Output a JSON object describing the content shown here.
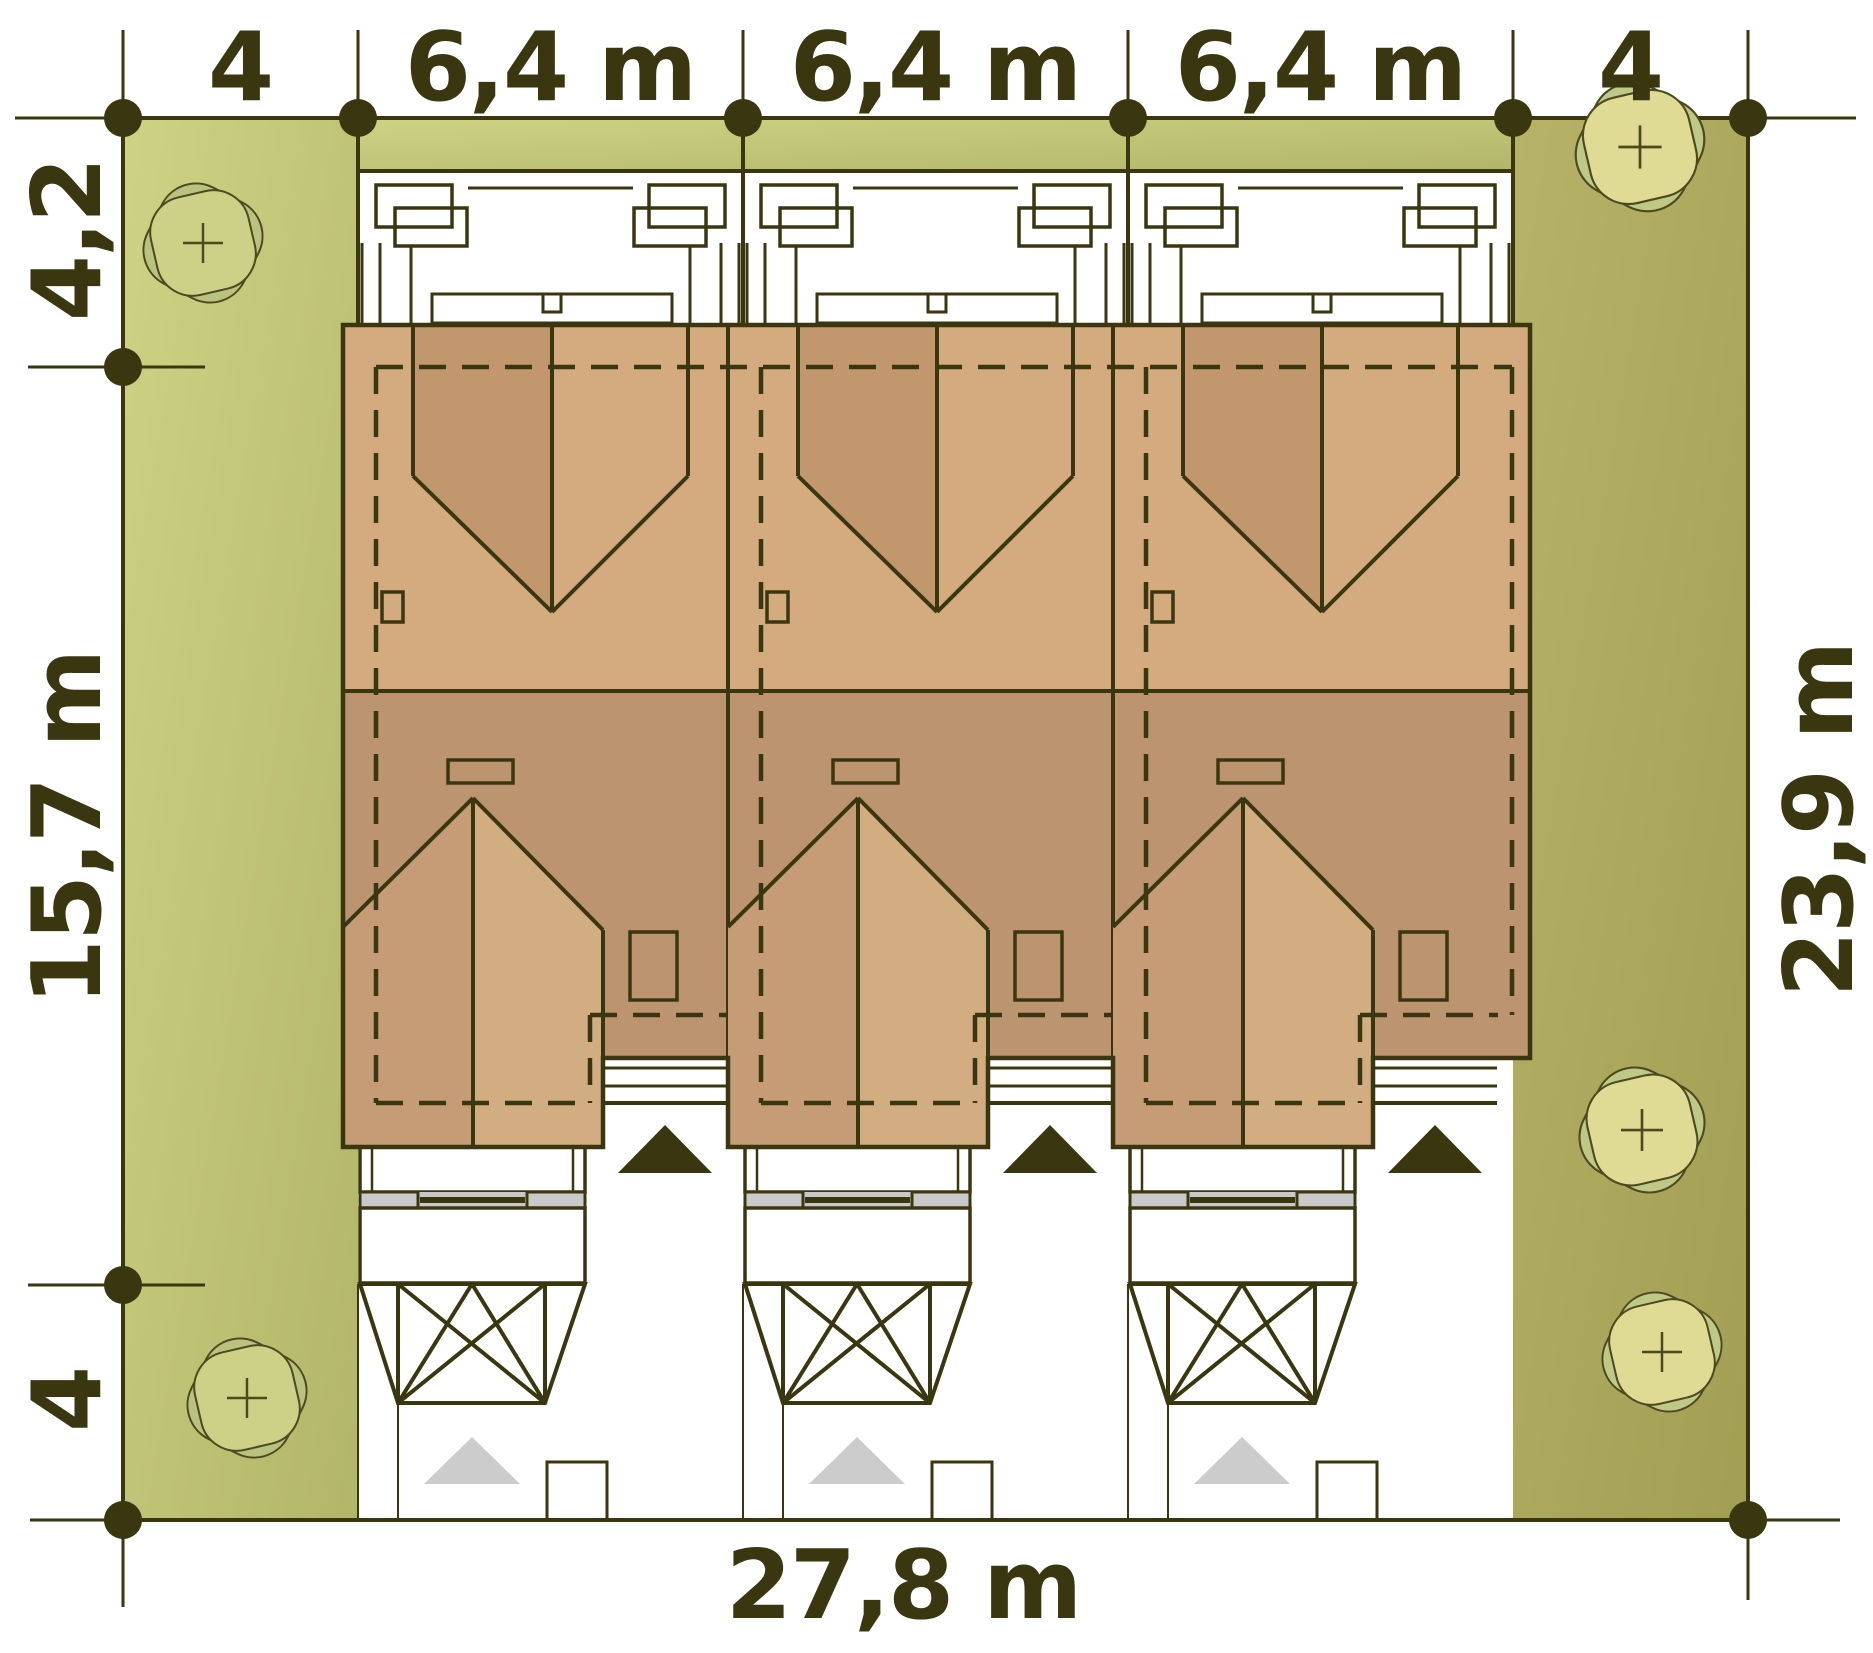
{
  "plan": {
    "kind": "residential site plan",
    "house_units": 3,
    "trees": 6
  },
  "dimensions": {
    "top": [
      "4",
      "6,4 m",
      "6,4 m",
      "6,4 m",
      "4"
    ],
    "left": [
      "4,2",
      "15,7 m",
      "4"
    ],
    "right": [
      "23,9 m"
    ],
    "bottom": [
      "27,8 m"
    ]
  },
  "colors": {
    "dark": "#3a3710",
    "grass1a": "#ced285",
    "grass1b": "#b3b668",
    "grass2a": "#b6b369",
    "grass2b": "#a29f53",
    "olive": "#b1ae62",
    "roofUpper": "#d3ab7f",
    "roofV": "#c2976e",
    "roofLower": "#bd9470",
    "gableL": "#c59c75",
    "gableR": "#d3ad82",
    "gray": "#c9c9c9",
    "grayLight": "#dadada",
    "grayTri": "#cccccc",
    "treeBackL": "#b9c27e",
    "treeFrontL": "#ccd187",
    "treeBackR": "#bfc987",
    "treeFrontR": "#dfdb94",
    "treeStroke": "#4c4a1e"
  }
}
